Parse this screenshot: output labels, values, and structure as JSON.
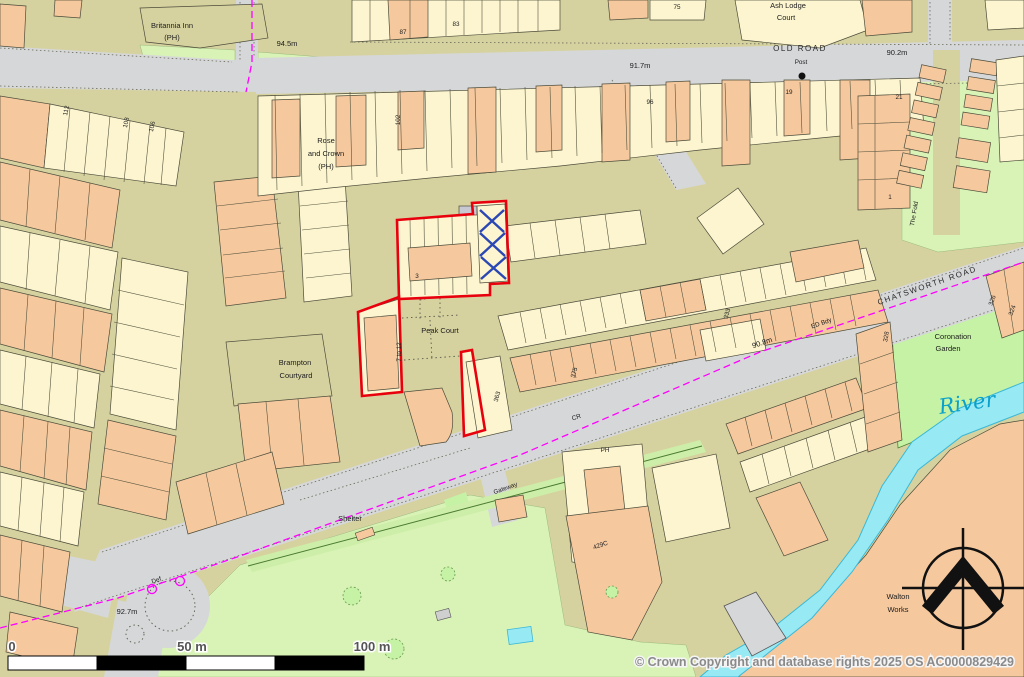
{
  "map": {
    "copyright": "© Crown Copyright and database rights 2025 OS AC0000829429",
    "scale_bar": {
      "zero": "0",
      "fifty": "50 m",
      "hundred": "100 m"
    },
    "colors": {
      "site_boundary_red": "#e8000d",
      "district_boundary_magenta": "#ff00ff",
      "river_fill": "#97e9f4",
      "river_edge": "#3bb8d6",
      "river_text": "#0aa0cc",
      "building_tan": "#f5c89e",
      "building_cream": "#fcf5d0",
      "road_fill": "#d6d7d9",
      "land": "#d6d2a0",
      "greenspace": "#d9f3b6",
      "garden_green": "#c5f2a4",
      "glasshouse_blue": "#2b47b4"
    },
    "labels": [
      {
        "t": "Britannia Inn",
        "x": 172,
        "y": 28,
        "r": 0,
        "c": "s"
      },
      {
        "t": "(PH)",
        "x": 172,
        "y": 40,
        "r": 0,
        "c": "s"
      },
      {
        "t": "94.5m",
        "x": 287,
        "y": 46,
        "r": 0,
        "c": "s"
      },
      {
        "t": "91.7m",
        "x": 640,
        "y": 68,
        "r": 0,
        "c": "s"
      },
      {
        "t": "OLD ROAD",
        "x": 800,
        "y": 51,
        "r": 0,
        "c": "road"
      },
      {
        "t": "Post",
        "x": 801,
        "y": 64,
        "r": 0,
        "c": "xs"
      },
      {
        "t": "90.2m",
        "x": 897,
        "y": 55,
        "r": 0,
        "c": "s"
      },
      {
        "t": "Ash Lodge",
        "x": 788,
        "y": 8,
        "r": 0,
        "c": "s"
      },
      {
        "t": "Court",
        "x": 786,
        "y": 20,
        "r": 0,
        "c": "s"
      },
      {
        "t": "75",
        "x": 677,
        "y": 9,
        "r": 0,
        "c": "xs"
      },
      {
        "t": "87",
        "x": 403,
        "y": 34,
        "r": 0,
        "c": "xs"
      },
      {
        "t": "83",
        "x": 456,
        "y": 26,
        "r": 0,
        "c": "xs"
      },
      {
        "t": "Rose",
        "x": 326,
        "y": 143,
        "r": 0,
        "c": "s"
      },
      {
        "t": "and Crown",
        "x": 326,
        "y": 156,
        "r": 0,
        "c": "s"
      },
      {
        "t": "(PH)",
        "x": 326,
        "y": 169,
        "r": 0,
        "c": "s"
      },
      {
        "t": "Brampton",
        "x": 295,
        "y": 365,
        "r": 0,
        "c": "s"
      },
      {
        "t": "Courtyard",
        "x": 296,
        "y": 378,
        "r": 0,
        "c": "s"
      },
      {
        "t": "Peak Court",
        "x": 440,
        "y": 333,
        "r": 0,
        "c": "s"
      },
      {
        "t": "7 to 12",
        "x": 401,
        "y": 352,
        "r": -90,
        "c": "xs"
      },
      {
        "t": "Shelter",
        "x": 350,
        "y": 521,
        "r": 0,
        "c": "s"
      },
      {
        "t": "Def",
        "x": 157,
        "y": 582,
        "r": -20,
        "c": "xs"
      },
      {
        "t": "92.7m",
        "x": 127,
        "y": 614,
        "r": 0,
        "c": "s"
      },
      {
        "t": "CR",
        "x": 577,
        "y": 419,
        "r": -19,
        "c": "xs"
      },
      {
        "t": "ED Bdy",
        "x": 822,
        "y": 325,
        "r": -19,
        "c": "xs"
      },
      {
        "t": "90.8m",
        "x": 763,
        "y": 345,
        "r": -19,
        "c": "s"
      },
      {
        "t": "CHATSWORTH ROAD",
        "x": 928,
        "y": 288,
        "r": -19,
        "c": "road"
      },
      {
        "t": "Coronation",
        "x": 953,
        "y": 339,
        "r": 0,
        "c": "s"
      },
      {
        "t": "Garden",
        "x": 948,
        "y": 351,
        "r": 0,
        "c": "s"
      },
      {
        "t": "River",
        "x": 968,
        "y": 410,
        "r": -8,
        "c": "river"
      },
      {
        "t": "Walton",
        "x": 898,
        "y": 599,
        "r": 0,
        "c": "s"
      },
      {
        "t": "Works",
        "x": 898,
        "y": 612,
        "r": 0,
        "c": "s"
      },
      {
        "t": "429C",
        "x": 601,
        "y": 547,
        "r": -19,
        "c": "xs"
      },
      {
        "t": "PH",
        "x": 605,
        "y": 452,
        "r": 0,
        "c": "xs"
      },
      {
        "t": "Gateway",
        "x": 506,
        "y": 490,
        "r": -20,
        "c": "xs"
      },
      {
        "t": "333",
        "x": 729,
        "y": 314,
        "r": -75,
        "c": "xs"
      },
      {
        "t": "375",
        "x": 576,
        "y": 373,
        "r": -75,
        "c": "xs"
      },
      {
        "t": "363",
        "x": 499,
        "y": 397,
        "r": -75,
        "c": "xs"
      },
      {
        "t": "328",
        "x": 888,
        "y": 337,
        "r": -80,
        "c": "xs"
      },
      {
        "t": "326",
        "x": 994,
        "y": 301,
        "r": -70,
        "c": "xs"
      },
      {
        "t": "324",
        "x": 1014,
        "y": 311,
        "r": -70,
        "c": "xs"
      },
      {
        "t": "The Fold",
        "x": 916,
        "y": 214,
        "r": -80,
        "c": "xs"
      },
      {
        "t": "112",
        "x": 68,
        "y": 111,
        "r": -78,
        "c": "xs"
      },
      {
        "t": "108",
        "x": 128,
        "y": 123,
        "r": -78,
        "c": "xs"
      },
      {
        "t": "106",
        "x": 154,
        "y": 127,
        "r": -78,
        "c": "xs"
      },
      {
        "t": "19",
        "x": 789,
        "y": 94,
        "r": 0,
        "c": "xs"
      },
      {
        "t": "21",
        "x": 899,
        "y": 99,
        "r": 0,
        "c": "xs"
      },
      {
        "t": "96",
        "x": 650,
        "y": 104,
        "r": 0,
        "c": "xs"
      },
      {
        "t": "102",
        "x": 400,
        "y": 120,
        "r": -90,
        "c": "xs"
      },
      {
        "t": "1",
        "x": 890,
        "y": 199,
        "r": 0,
        "c": "xs"
      },
      {
        "t": "3",
        "x": 417,
        "y": 278,
        "r": 0,
        "c": "xs"
      }
    ]
  }
}
